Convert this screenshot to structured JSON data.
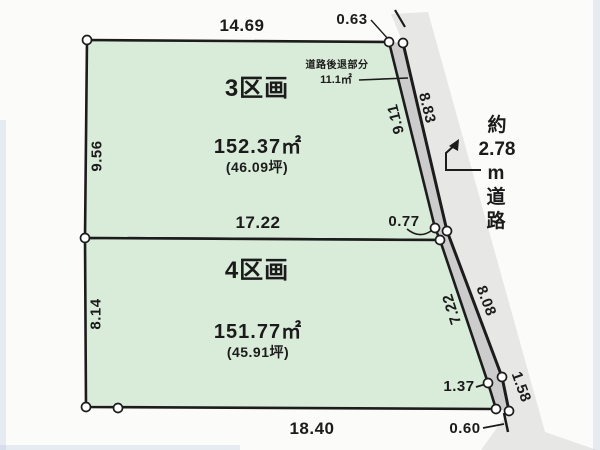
{
  "colors": {
    "background": "#fbfbf9",
    "parcel_fill": "#d9ebd9",
    "road_fill": "#e7e7e5",
    "setback_fill": "#cccccc",
    "line": "#1c1c1c",
    "text": "#1b1b1b"
  },
  "parcels": [
    {
      "name": "3区画",
      "area": "152.37㎡",
      "area_tsubo": "(46.09坪)"
    },
    {
      "name": "4区画",
      "area": "151.77㎡",
      "area_tsubo": "(45.91坪)"
    }
  ],
  "dims": {
    "top3": "14.69",
    "corner063": "0.63",
    "left3": "9.56",
    "inner3": "9.11",
    "outer_upper": "8.83",
    "mid": "17.22",
    "d077": "0.77",
    "left4": "8.14",
    "inner4": "7.22",
    "outer_lower": "8.08",
    "bottom4": "18.40",
    "d137": "1.37",
    "d158": "1.58",
    "d060": "0.60"
  },
  "road": {
    "setback_title": "道路後退部分",
    "setback_area": "11.1㎡",
    "width_label": [
      "約",
      "2.78",
      "m",
      "道",
      "路"
    ]
  }
}
